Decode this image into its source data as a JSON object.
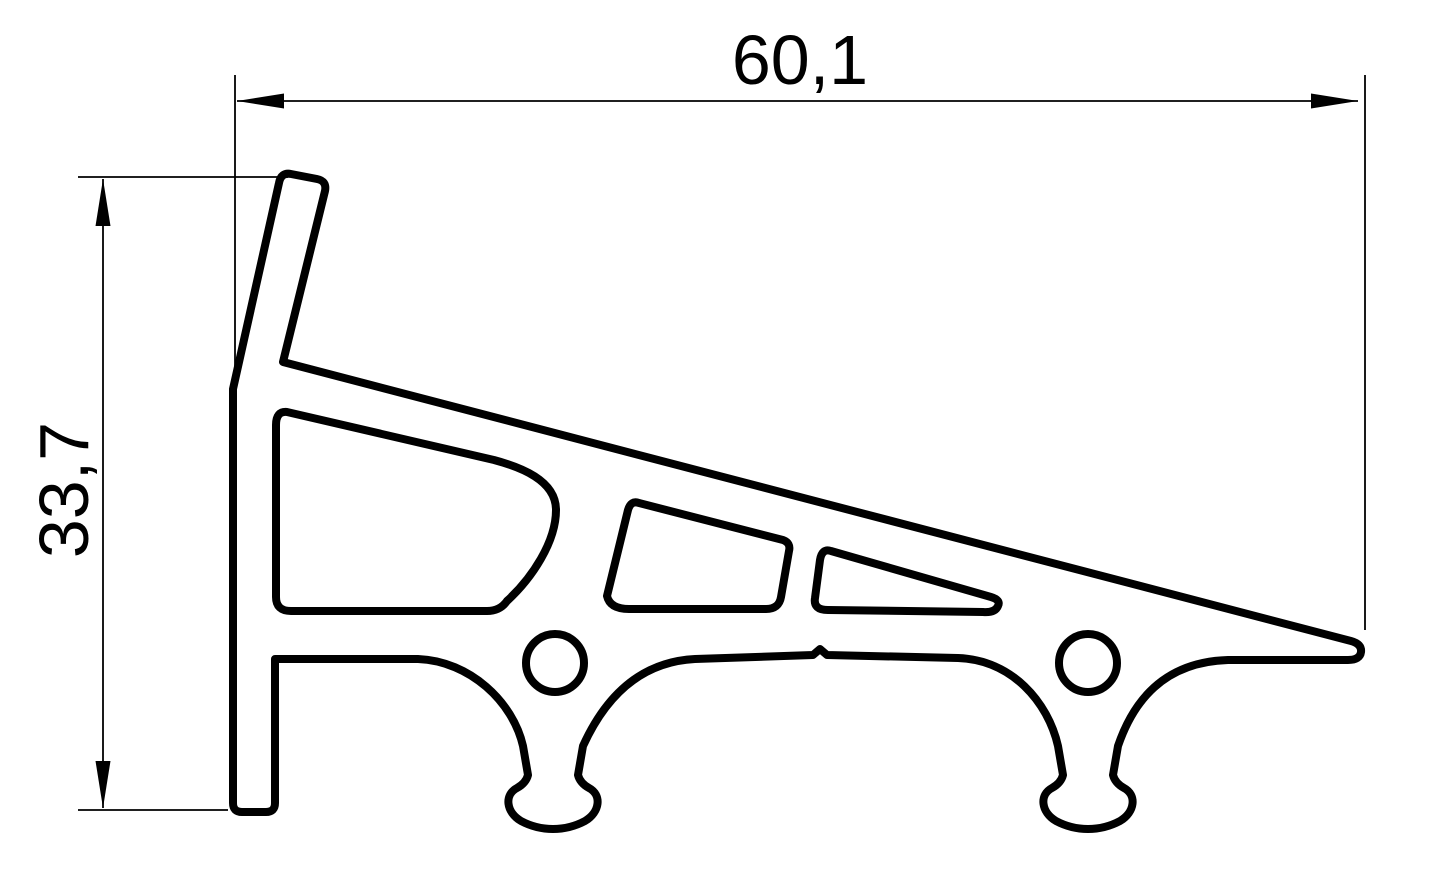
{
  "page": {
    "background_color": "#ffffff",
    "line_color": "#000000"
  },
  "drawing": {
    "type": "technical-profile-cross-section",
    "width_dimension": {
      "label": "60,1"
    },
    "height_dimension": {
      "label": "33,7"
    }
  }
}
